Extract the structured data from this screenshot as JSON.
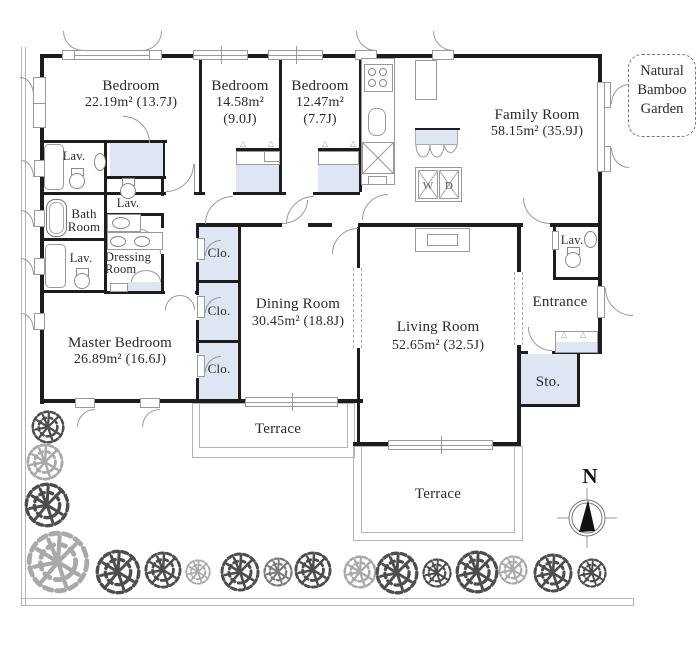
{
  "plan": {
    "rooms": {
      "bedroom1": {
        "name": "Bedroom",
        "area": "22.19m² (13.7J)"
      },
      "bedroom2": {
        "name": "Bedroom",
        "area": "14.58m²",
        "tatami": "(9.0J)"
      },
      "bedroom3": {
        "name": "Bedroom",
        "area": "12.47m²",
        "tatami": "(7.7J)"
      },
      "family": {
        "name": "Family Room",
        "area": "58.15m² (35.9J)"
      },
      "master": {
        "name": "Master Bedroom",
        "area": "26.89m² (16.6J)"
      },
      "dining": {
        "name": "Dining Room",
        "area": "30.45m² (18.8J)"
      },
      "living": {
        "name": "Living Room",
        "area": "52.65m² (32.5J)"
      },
      "entrance": {
        "name": "Entrance"
      },
      "storage": {
        "name": "Sto."
      }
    },
    "labels": {
      "lav": "Lav.",
      "clo": "Clo.",
      "terrace": "Terrace",
      "bath1": "Bath",
      "bath2": "Room",
      "dress1": "Dressing",
      "dress2": "Room",
      "washer": "W",
      "dryer": "D"
    },
    "garden": {
      "line1": "Natural",
      "line2": "Bamboo",
      "line3": "Garden"
    },
    "compass": {
      "north": "N"
    },
    "colors": {
      "wall": "#1d1d1d",
      "closet": "#dde6f2",
      "line": "#999999",
      "tree_dark": "#4d4d4d",
      "tree_mid": "#7a7a7a",
      "tree_light": "#a9a9a9"
    }
  }
}
